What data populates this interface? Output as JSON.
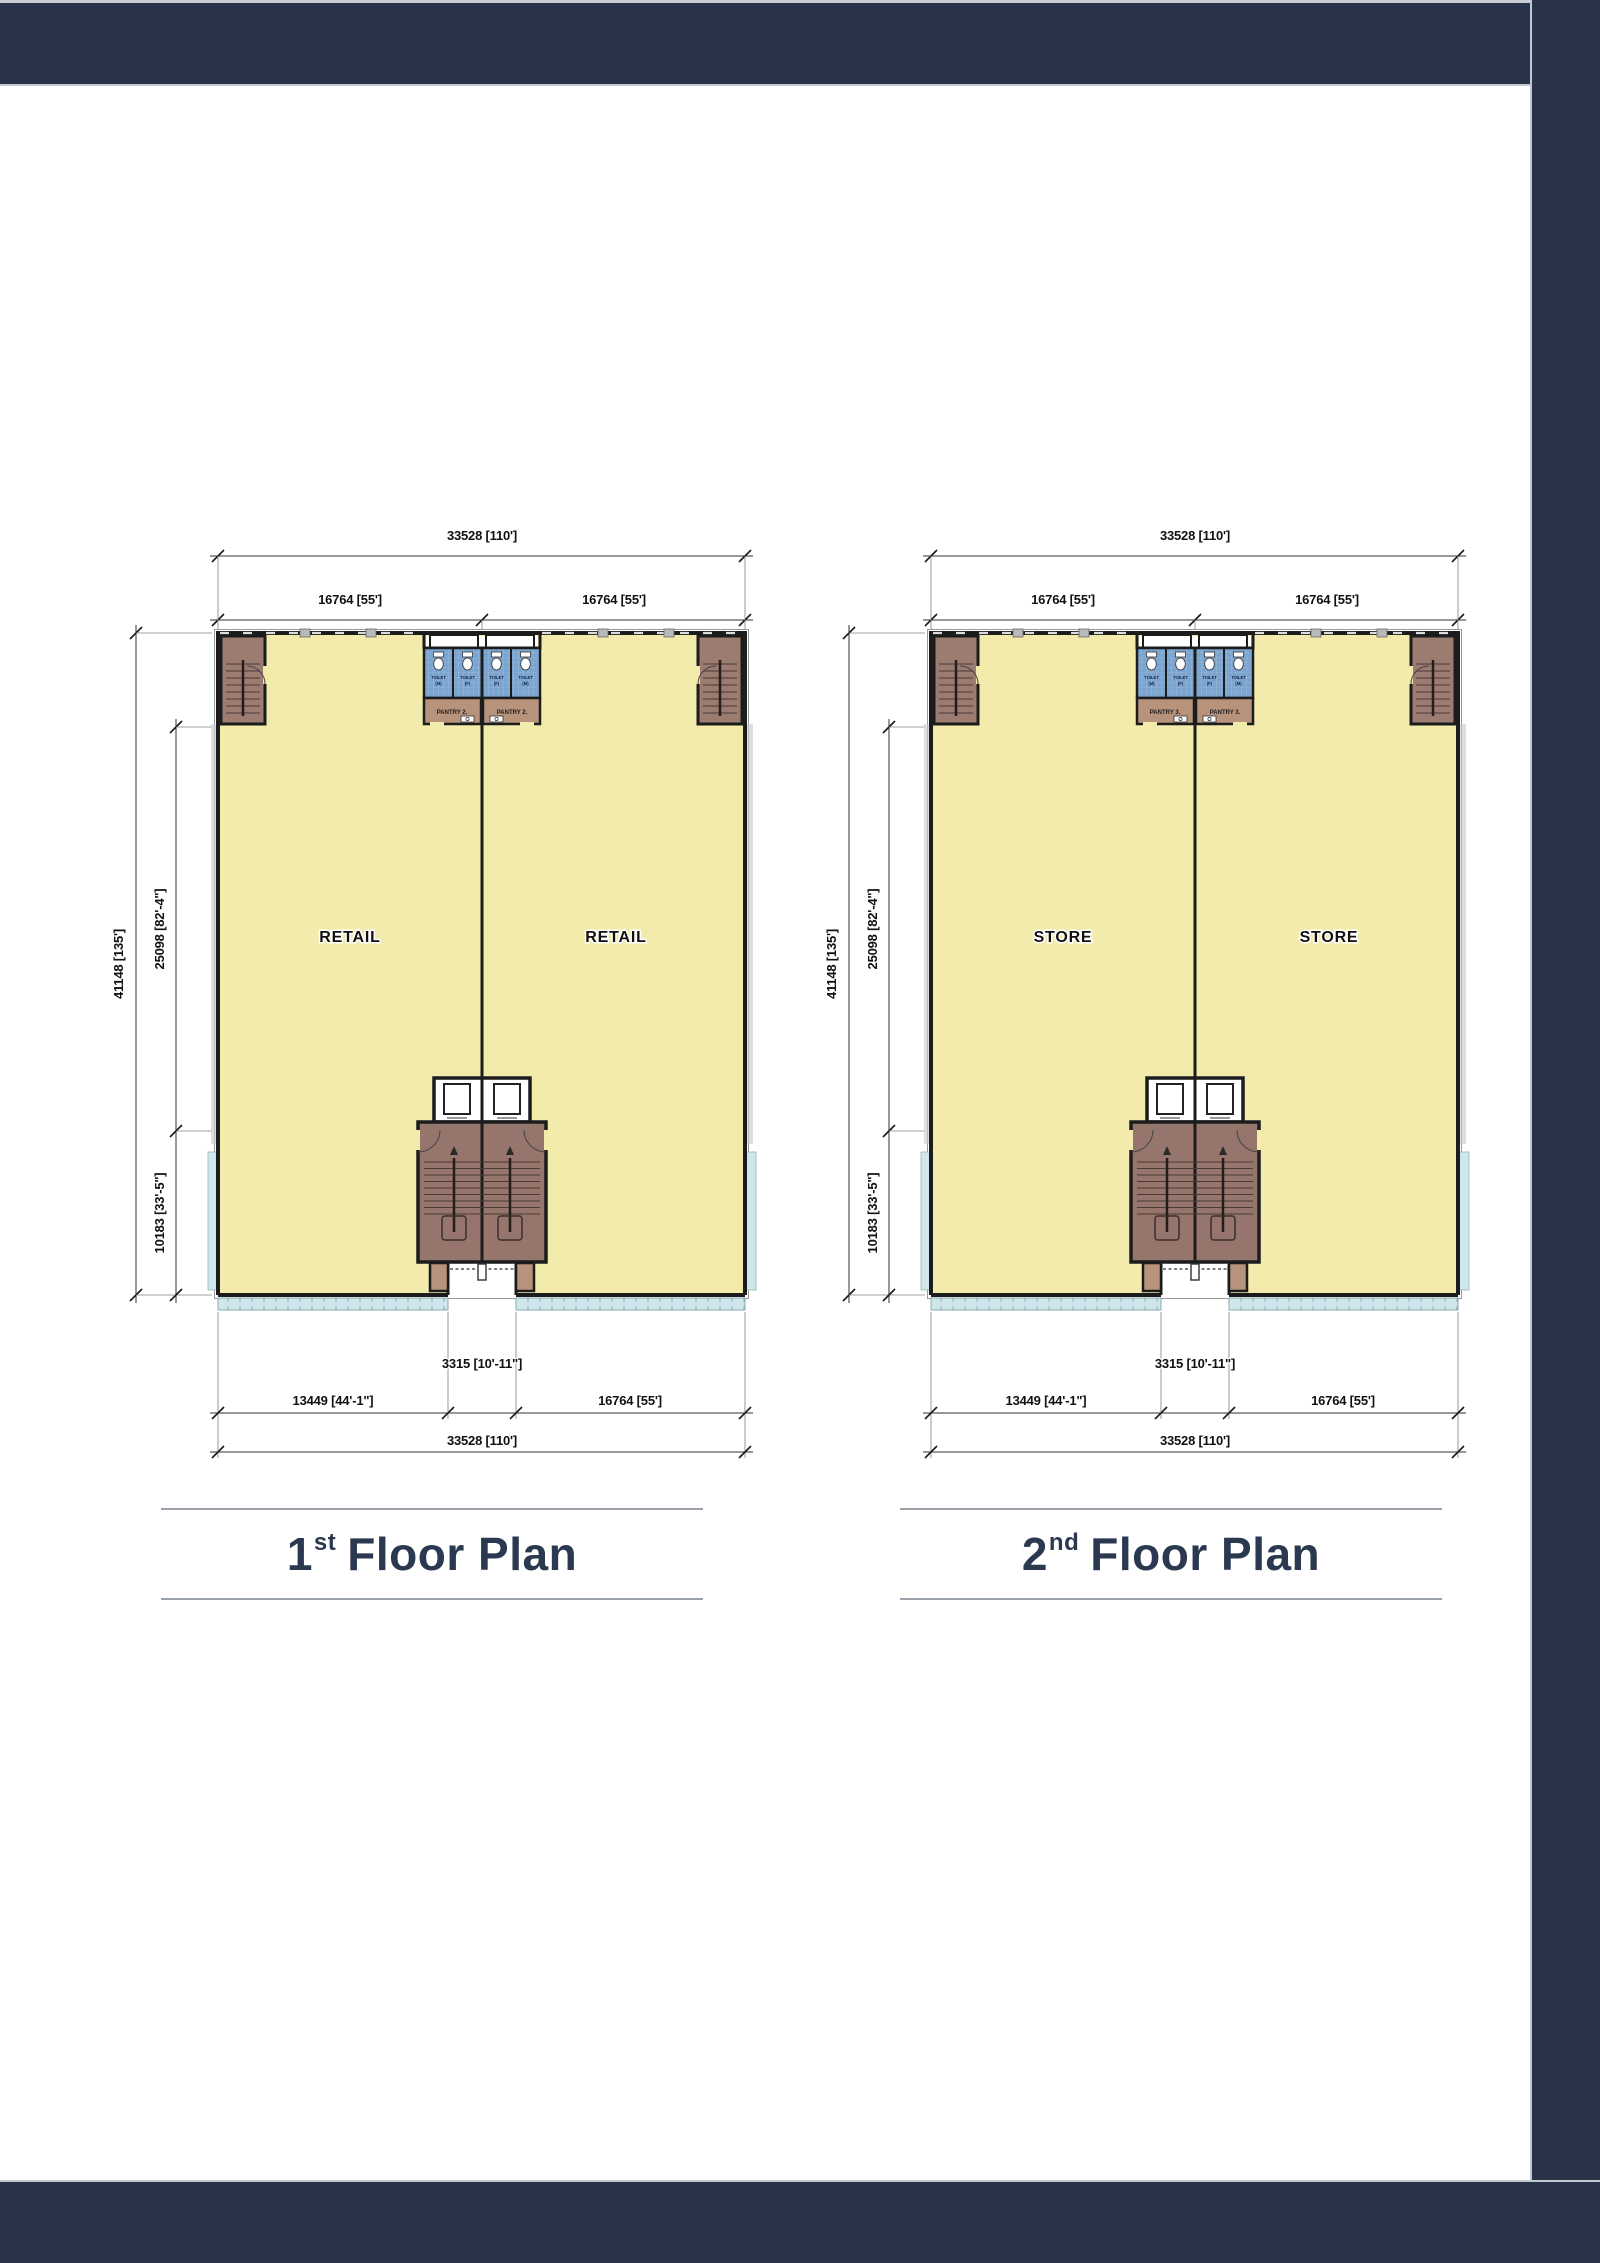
{
  "page": {
    "background": "#ffffff"
  },
  "colors": {
    "navy": "#283349",
    "floor": "#f2ebab",
    "stair": "#9c7b71",
    "core": "#96756c",
    "pantry": "#b8937c",
    "toilet": "#7ba4cf",
    "sill": "#cfe6ea",
    "wall": "#1c1c1c",
    "title": "#2b3950",
    "rule": "#9aa0a8",
    "dim": "#111111"
  },
  "plans": [
    {
      "title_num": "1",
      "title_sup": "st",
      "title_rest": "Floor Plan",
      "unit_label": "RETAIL",
      "pantry_label": "PANTRY 2.",
      "stalls": [
        {
          "label": "TOILET",
          "sub": "(M)"
        },
        {
          "label": "TOILET",
          "sub": "(F)"
        },
        {
          "label": "TOILET",
          "sub": "(F)"
        },
        {
          "label": "TOILET",
          "sub": "(M)"
        }
      ],
      "dims": {
        "top_overall": "33528 [110']",
        "top_left": "16764 [55']",
        "top_right": "16764 [55']",
        "side_overall": "41148 [135']",
        "side_upper": "25098 [82'-4\"]",
        "side_lower": "10183 [33'-5\"]",
        "bottom_recess": "3315 [10'-11\"]",
        "bottom_left": "13449 [44'-1\"]",
        "bottom_right": "16764 [55']",
        "bottom_overall": "33528 [110']"
      }
    },
    {
      "title_num": "2",
      "title_sup": "nd",
      "title_rest": "Floor Plan",
      "unit_label": "STORE",
      "pantry_label": "PANTRY 3.",
      "stalls": [
        {
          "label": "TOILET",
          "sub": "(M)"
        },
        {
          "label": "TOILET",
          "sub": "(F)"
        },
        {
          "label": "TOILET",
          "sub": "(F)"
        },
        {
          "label": "TOILET",
          "sub": "(M)"
        }
      ],
      "dims": {
        "top_overall": "33528 [110']",
        "top_left": "16764 [55']",
        "top_right": "16764 [55']",
        "side_overall": "41148 [135']",
        "side_upper": "25098 [82'-4\"]",
        "side_lower": "10183 [33'-5\"]",
        "bottom_recess": "3315 [10'-11\"]",
        "bottom_left": "13449 [44'-1\"]",
        "bottom_right": "16764 [55']",
        "bottom_overall": "33528 [110']"
      }
    }
  ]
}
